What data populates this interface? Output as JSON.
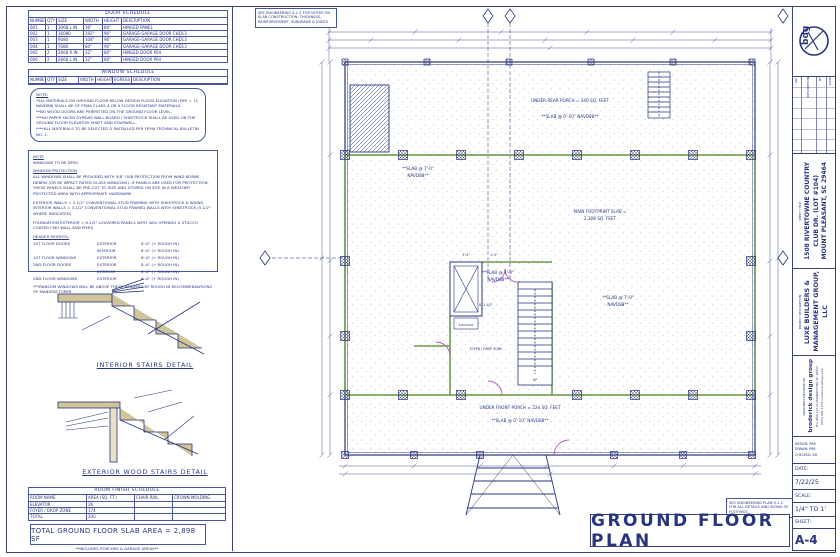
{
  "sheet_meta": {
    "title": "GROUND FLOOR PLAN",
    "slab_note": "SEE ENGINEERING S-1.2 FOR NOTES ON SLAB CONSTRUCTION: THICKNESS, REINFORCEMENT, SUBGRADE & JOINTS",
    "footings_note": "SEE ENGINEERING PLAN S-1.2 FOR ALL DETAILS AND SIZING OF FOOTINGS"
  },
  "door_schedule": {
    "title": "DOOR SCHEDULE",
    "headers": [
      "NUMBER",
      "QTY",
      "SIZE",
      "WIDTH",
      "HEIGHT",
      "DESCRIPTION"
    ],
    "rows": [
      [
        "001",
        "1",
        "3068 L IN",
        "36\"",
        "80\"",
        "HINGED PANEL"
      ],
      [
        "002",
        "1",
        "16080",
        "192\"",
        "96\"",
        "GARAGE-GARAGE DOOR CHD13"
      ],
      [
        "003",
        "1",
        "9080",
        "108\"",
        "96\"",
        "GARAGE-GARAGE DOOR CHD13"
      ],
      [
        "004",
        "1",
        "7080",
        "84\"",
        "96\"",
        "GARAGE-GARAGE DOOR CHD13"
      ],
      [
        "005",
        "2",
        "2668 R IN",
        "32\"",
        "80\"",
        "HINGED DOOR P04"
      ],
      [
        "006",
        "2",
        "2668 L IN",
        "32\"",
        "80\"",
        "HINGED DOOR P04"
      ]
    ]
  },
  "window_schedule": {
    "title": "WINDOW SCHEDULE",
    "headers": [
      "NUMBER",
      "QTY",
      "SIZE",
      "WIDTH",
      "HEIGHT",
      "EGRESS",
      "DESCRIPTION"
    ],
    "rows": [
      [
        "",
        "",
        "",
        "",
        "",
        "",
        ""
      ]
    ]
  },
  "flood_note": {
    "title": "NOTE:",
    "lines": [
      "*ALL MATERIALS ON GROUND FLOOR BELOW DESIGN FLOOD ELEVATION (DFE = 11 NAVD88) SHALL BE OF FEMA CLASS 4 OR 5 FLOOD RESISTANT MATERIALS.",
      "**NO WOOD DOORS ARE PERMITTED ON THE GROUND FLOOR LEVEL.",
      "***NO PAPER FACED GYPSUM WALL BOARD / SHEETROCK SHALL BE USED ON THE GROUND FLOOR ELEVATOR SHAFT AND STAIRWELL.",
      "****ALL MATERIALS TO BE SELECTED & INSTALLED PER FEMA TECHNICAL BULLETIN NO. 2."
    ]
  },
  "construction_note": {
    "note_label": "NOTE",
    "windows_line": "WINDOWS TO BE DP50",
    "heading1": "WINDOW PROTECTION",
    "para1": "ALL WINDOWS SHALL BE PROVIDED WITH 5/8\" OSB PROTECTION FROM WIND BORNE DEBRIS (OR BE IMPACT RATED GLASS WINDOWS). IF PANELS ARE USED FOR PROTECTION, THESE PANELS SHALL BE PRE-CUT TO SIZE AND STORED ON SITE IN A WEATHER PROTECTED AREA WITH APPROPRIATE HARDWARE.",
    "ext_wall": "EXTERIOR WALLS = 5-1/2\" CONVENTIONAL STUD FRAMING WITH SHEETROCK & SIDING",
    "int_wall": "INTERIOR WALLS = 3-1/2\" CONVENTIONAL STUD FRAMED WALLS WITH SHEETROCK (5-1/2\" WHERE INDICATED)",
    "foundation": "FOUNDATION EXTERIOR = 8-1/2\" LOUVERED PANELS WITH 40% OPENING & STUCCO COATED CMU WALL AND PIERS",
    "heading2": "HEADER HEIGHTS:",
    "header_rows": [
      [
        "1ST FLOOR DOORS",
        "EXTERIOR",
        "8'-0\" (+ ROUGH IN)"
      ],
      [
        "",
        "INTERIOR",
        "8'-0\" (+ ROUGH IN)"
      ],
      [
        "1ST FLOOR WINDOWS",
        "EXTERIOR",
        "8'-0\" (+ ROUGH IN)"
      ],
      [
        "2ND FLOOR DOORS",
        "EXTERIOR",
        "8'-0\" (+ ROUGH IN)"
      ],
      [
        "",
        "INTERIOR",
        "8'-0\" (+ ROUGH IN)"
      ],
      [
        "2ND FLOOR WINDOWS",
        "EXTERIOR",
        "8'-0\" (+ ROUGH IN)"
      ]
    ],
    "footnote": "**TRANSOM WINDOWS WILL BE ABOVE THESE HEADERS BY ROUGH IN RECOMMENDATIONS OF MANUFACTURER"
  },
  "details": {
    "interior_label": "INTERIOR STAIRS DETAIL",
    "exterior_label": "EXTERIOR WOOD STAIRS DETAIL"
  },
  "room_finish_schedule": {
    "title": "ROOM FINISH SCHEDULE",
    "headers": [
      "ROOM NAME",
      "AREA (SQ. FT.)",
      "CHAIR RAIL",
      "CROWN MOLDING"
    ],
    "rows": [
      [
        "ELEVATOR",
        "26",
        "",
        ""
      ],
      [
        "FOYER / DROP ZONE",
        "174",
        "",
        ""
      ],
      [
        "TOTAL",
        "200",
        "",
        ""
      ]
    ]
  },
  "totals": {
    "slab_area": "TOTAL GROUND FLOOR SLAB AREA  = 2,898 SF",
    "note": "**INCLUDES PORCHES & GARAGE AREAS**"
  },
  "plan": {
    "annotations": {
      "rear_porch": "UNDER REAR PORCH = 340 SQ. FEET",
      "slab_rear": "**SLAB @ 0'-10\" NAVD88**",
      "slab_left_1": "**SLAB @ 7'-0\"",
      "slab_left_2": "NAVD88**",
      "main_1": "MAIN FOOTPRINT SLAB =",
      "main_2": "2,308 SQ. FEET",
      "slab_center_1": "**SLAB @ 7'-0\"",
      "slab_center_2": "NAVD88**",
      "slab_right_1": "**SLAB @ 7'-0\"",
      "slab_right_2": "NAVD88**",
      "front_porch": "UNDER FRONT PORCH = 224 SQ. FEET",
      "slab_front": "**SLAB @ 0'-10\" NAVD88**",
      "up": "UP",
      "foyer": "FOYER / DROP ZONE",
      "elevator": "ELEVATOR"
    },
    "dims": {
      "d1": "3'-4\"",
      "d2": "2'-0\"",
      "d3": "8'-1 1/2\""
    }
  },
  "title_block": {
    "logo_text": "bdg",
    "revisions": {
      "headers": [
        "NO.",
        "DESCRIPTION",
        "BY",
        "DATE"
      ]
    },
    "sheet_title_label": "SHEET TITLE:",
    "sheet_title_l1": "1508 RIVERTOWNE COUNTRY",
    "sheet_title_l2": "CLUB DR. (LOT #104)",
    "sheet_title_l3": "MOUNT PLEASANT, SC 29464",
    "project_label": "PROJECT DESCRIPTION:",
    "project_l1": "LUXE BUILDERS &",
    "project_l2": "MANAGEMENT GROUP,",
    "project_l3": "LLC",
    "provided_label": "DRAWINGS PROVIDED BY:",
    "firm": "broderick design group",
    "contact1": "P.O. BOX 12113  CHARLESTON, SC 29422",
    "contact2": "(843) 991-1237  broderick-design.com",
    "design": "DESIGN:  PRB",
    "drawn": "DRAWN:  PRB",
    "checked": "CHECKED:  BD",
    "date_label": "DATE:",
    "date": "7/22/25",
    "scale_label": "SCALE:",
    "scale": "1/4\" TO 1'",
    "sheet_label": "SHEET:",
    "sheet": "A-4"
  },
  "colors": {
    "ink": "#29357d",
    "wall_green": "#6f9a49",
    "door_magenta": "#a85ec0"
  }
}
